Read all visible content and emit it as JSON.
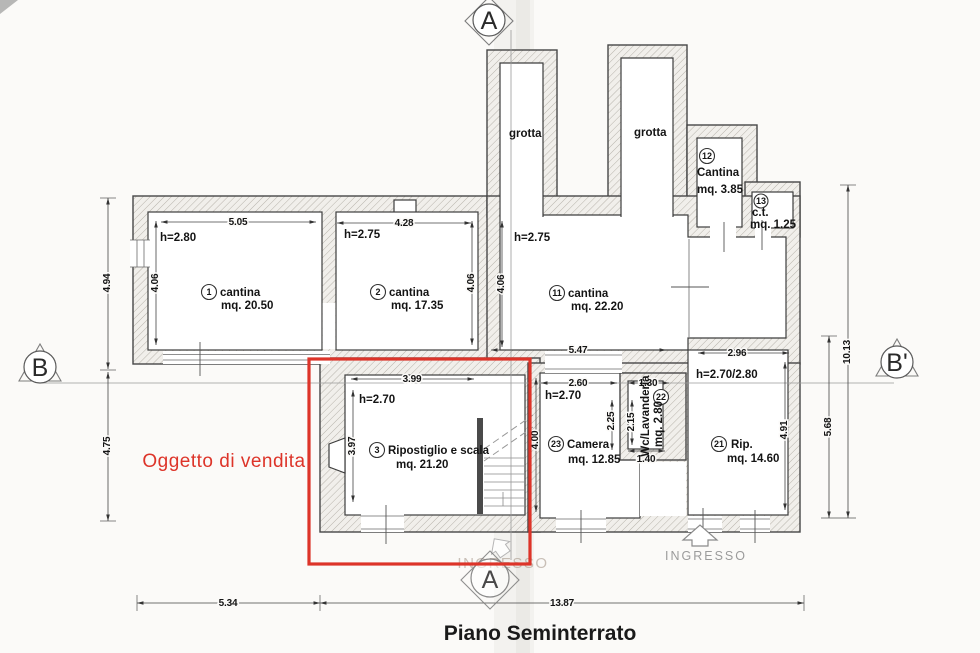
{
  "title": "Piano Seminterrato",
  "overlay": {
    "label": "Oggetto di vendita",
    "color": "#dd3429"
  },
  "markers": {
    "section_a_top": "A",
    "section_a_bottom": "A",
    "section_b_left": "B",
    "section_b_right": "B'"
  },
  "entrance": {
    "label": "INGRESSO",
    "watermark": "INGRESSO"
  },
  "grotta": {
    "left": "grotta",
    "right": "grotta"
  },
  "rooms": {
    "r1": {
      "num": "1",
      "name": "cantina",
      "area": "mq. 20.50",
      "height": "h=2.80"
    },
    "r2": {
      "num": "2",
      "name": "cantina",
      "area": "mq. 17.35",
      "height": "h=2.75"
    },
    "r3": {
      "num": "3",
      "name": "Ripostiglio e scala",
      "area": "mq. 21.20",
      "height": "h=2.70"
    },
    "r11": {
      "num": "11",
      "name": "cantina",
      "area": "mq. 22.20",
      "height": "h=2.75"
    },
    "r12": {
      "num": "12",
      "name": "Cantina",
      "area": "mq. 3.85"
    },
    "r13": {
      "num": "13",
      "name": "c.t.",
      "area": "mq. 1.25"
    },
    "r21": {
      "num": "21",
      "name": "Rip.",
      "area": "mq. 14.60",
      "height": "h=2.70/2.80"
    },
    "r22": {
      "num": "22",
      "name": "Wc/Lavanderia",
      "area": "mq. 2.80"
    },
    "r23": {
      "num": "23",
      "name": "Camera",
      "area": "mq. 12.85",
      "height": "h=2.70"
    }
  },
  "dimensions": {
    "room1_width": "5.05",
    "room1_depth": "4.06",
    "room2_width": "4.28",
    "room2_depth": "4.06",
    "room11_depth": "4.06",
    "room11_width": "5.47",
    "room21_width": "2.96",
    "room21_depth": "4.91",
    "room3_width": "3.99",
    "room3_depth": "3.97",
    "room23_depth": "4.00",
    "room23_w1": "2.60",
    "room23_w2": "1.30",
    "wc_d1": "2.25",
    "wc_d2": "2.15",
    "wc_width": "1.40",
    "left_upper": "4.94",
    "left_lower": "4.75",
    "right_total": "10.13",
    "right_lower": "5.68",
    "bottom_left": "5.34",
    "bottom_right": "13.87"
  }
}
